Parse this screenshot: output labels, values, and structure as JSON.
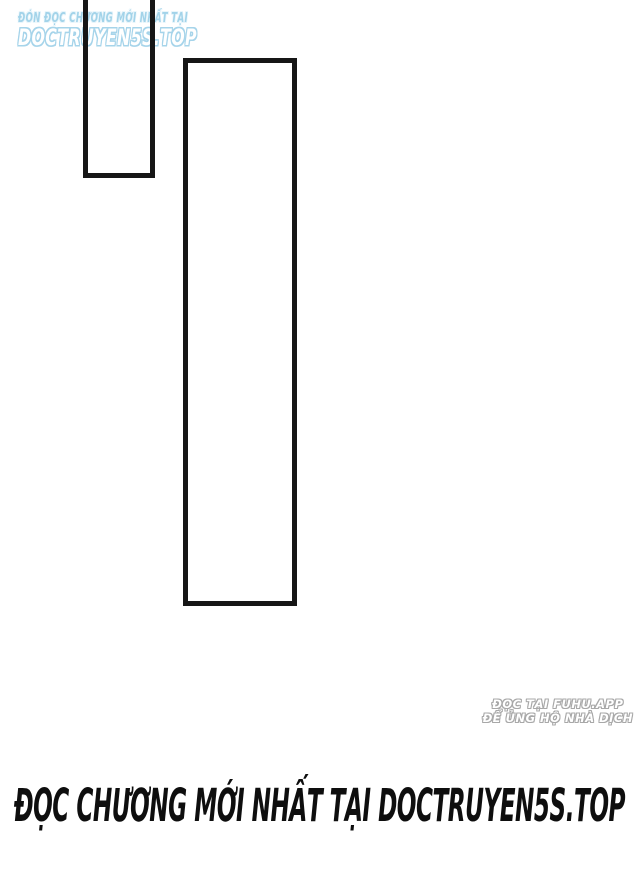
{
  "page": {
    "kind": "manga-scan-page",
    "background_color": "#ffffff",
    "panel_border_color": "#161616"
  },
  "top_watermark": {
    "line1": "ĐÓN ĐỌC CHƯƠNG MỚI NHẤT TẠI",
    "line2": "DOCTRUYEN5S.TOP",
    "color": "#a6d4ea"
  },
  "bottom_right_credit": {
    "line1": "ĐỌC TẠI FUHU.APP",
    "line2": "ĐỂ ỦNG HỘ NHÀ DỊCH",
    "color": "#a8a8a8"
  },
  "footer_banner": {
    "text": "ĐỌC CHƯƠNG MỚI NHẤT TẠI DOCTRUYEN5S.TOP",
    "color": "#0e0e0e"
  }
}
